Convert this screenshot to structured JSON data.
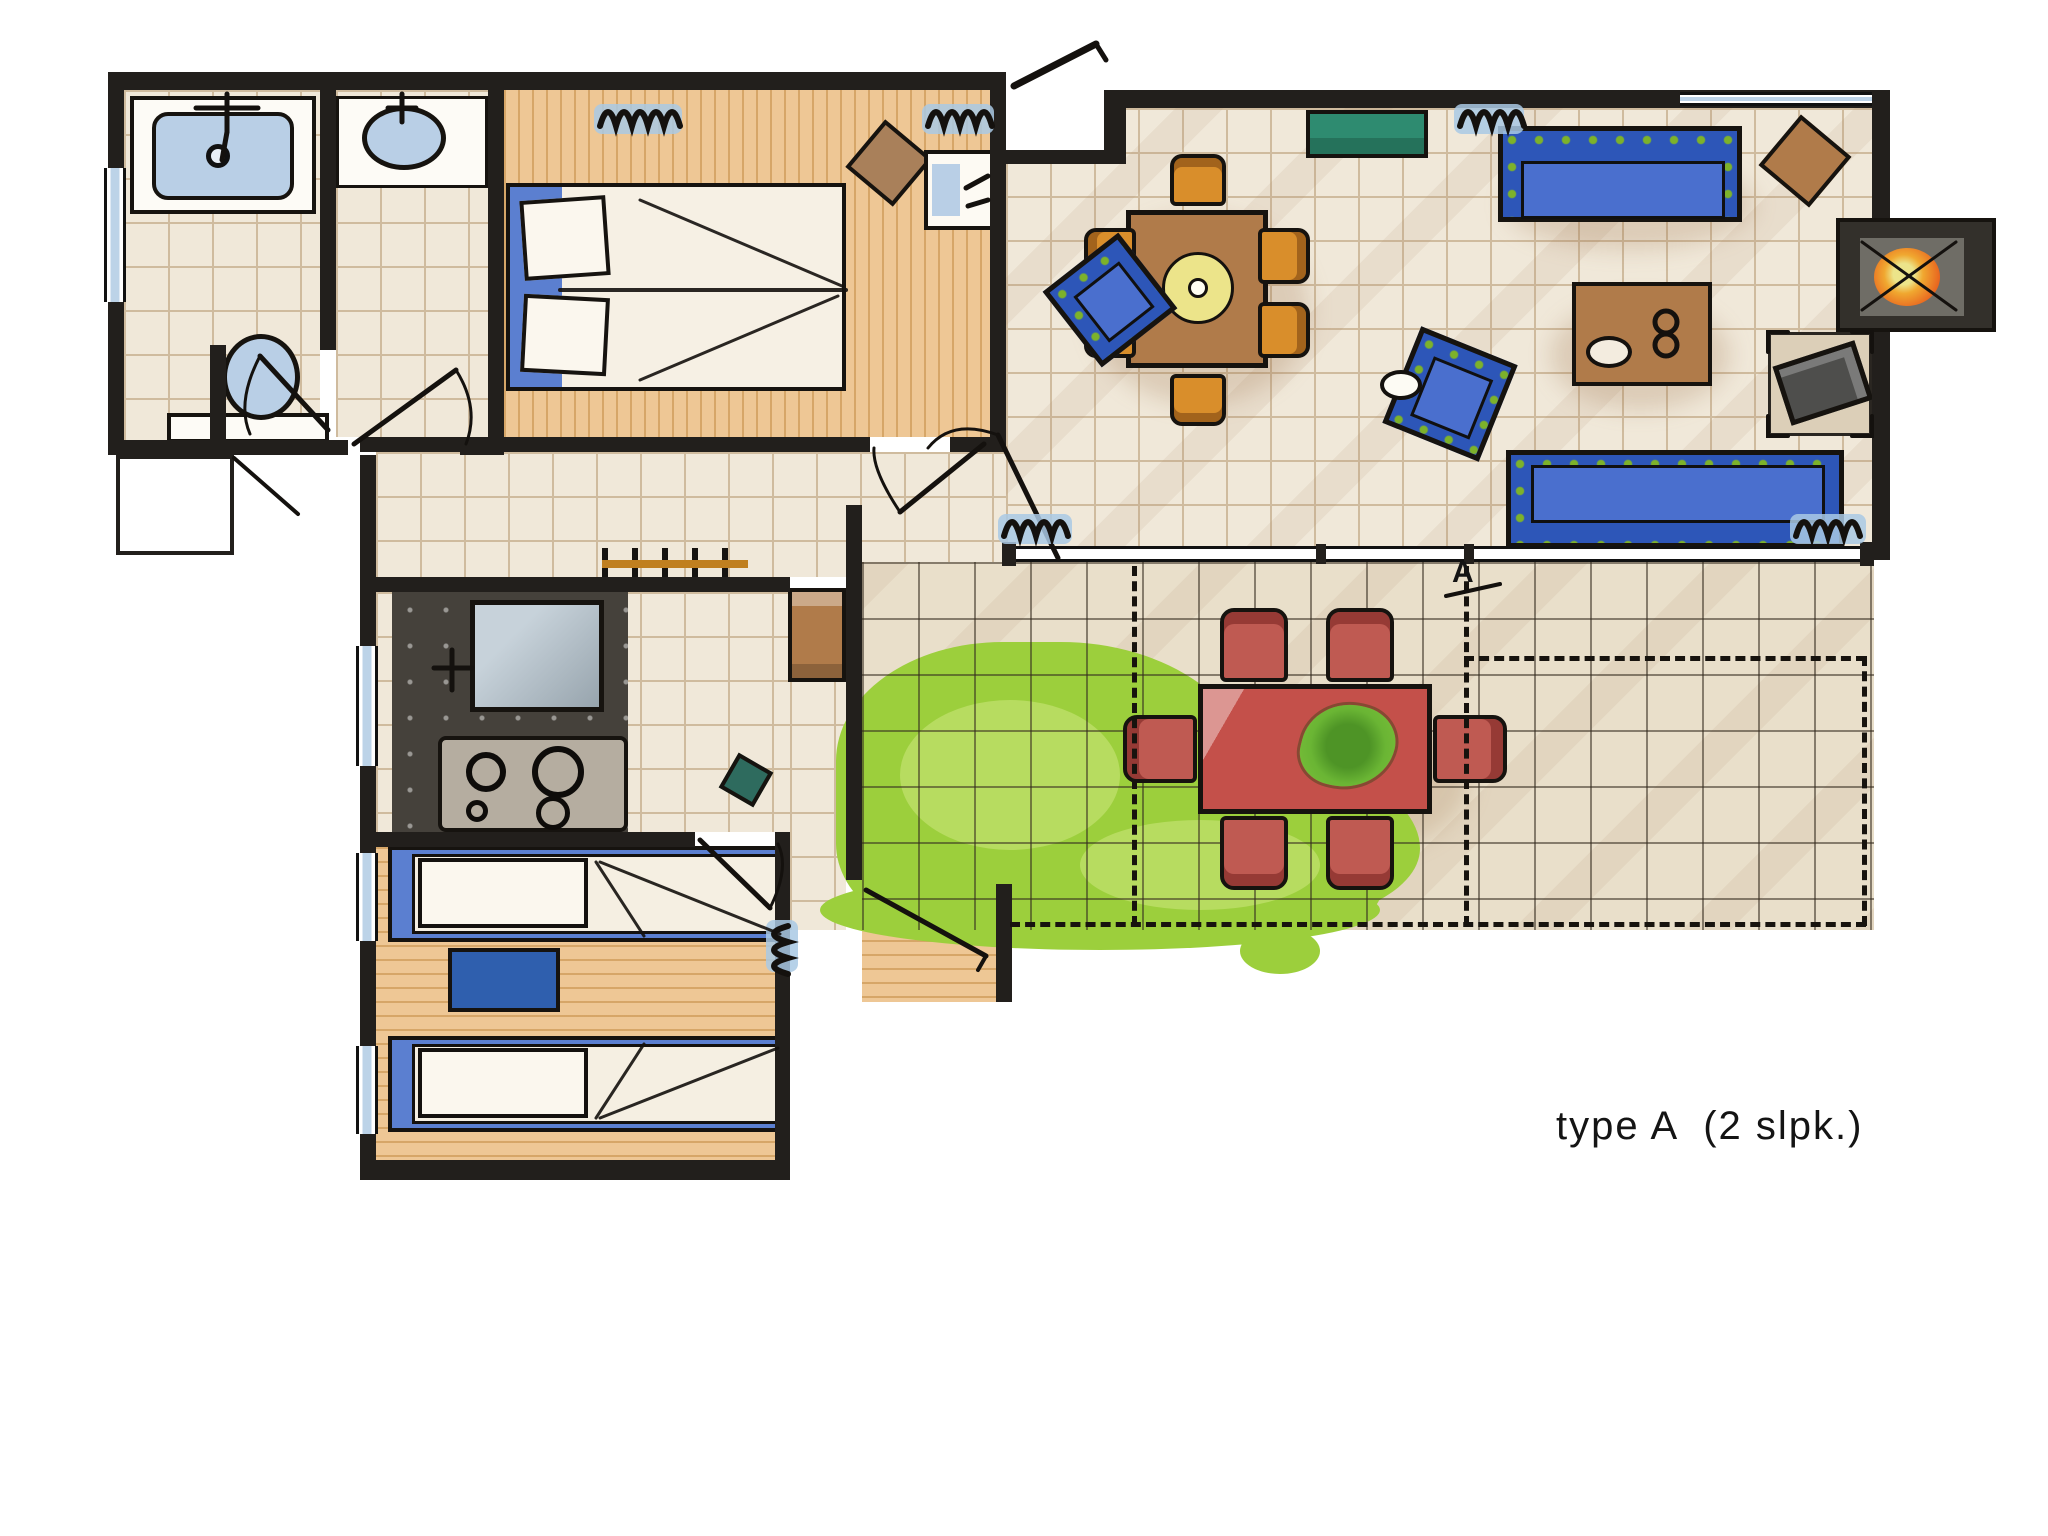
{
  "caption": {
    "text": "type A  (2 slpk.)"
  },
  "terrace": {
    "marker_label": "A"
  },
  "colors": {
    "wall": "#221f1c",
    "tile_floor": "#f0e8d9",
    "tile_line": "#cfbb9e",
    "terrace_floor": "#e9dfca",
    "wood_floor": "#eec795",
    "sanitary_blue": "#b9cfe6",
    "window_blue": "#bcd3e8",
    "bed_blue": "#5b7fd0",
    "night_blue": "#2f5fae",
    "sofa_blue": "#2d56b8",
    "sofa_dot": "#7db22a",
    "green_cabinet": "#2e8b70",
    "grass_green": "#9ccf3c",
    "grass_light": "#b7dc60",
    "table_brown": "#b07b4a",
    "chair_orange": "#d98e2b",
    "chair_brown": "#a9805a",
    "counter_dark": "#45413b",
    "stove_gray": "#b5ada0",
    "red_table": "#c4504a",
    "red_chair": "#bf5a52",
    "fire_orange": "#e8641f",
    "tv_gray": "#4e4e4c",
    "plate_yellow": "#ece48a"
  },
  "rooms": [
    {
      "name": "bathroom"
    },
    {
      "name": "washroom"
    },
    {
      "name": "bedroom-1"
    },
    {
      "name": "hallway"
    },
    {
      "name": "kitchen"
    },
    {
      "name": "bedroom-2"
    },
    {
      "name": "living-room"
    },
    {
      "name": "terrace"
    },
    {
      "name": "garden"
    },
    {
      "name": "storage-shed"
    }
  ],
  "furniture": [
    "shower",
    "washbasin",
    "toilet",
    "double-bed",
    "bedroom-chair",
    "bedroom-washstand",
    "coat-rack",
    "kitchen-counter",
    "kitchen-sink",
    "stove",
    "hall-cabinet",
    "single-bed",
    "nightstand",
    "dining-table",
    "dining-chair",
    "sideboard",
    "sofa",
    "armchair",
    "coffee-table",
    "side-table",
    "fireplace",
    "tv",
    "patio-table",
    "patio-chair",
    "plant",
    "lawn"
  ]
}
